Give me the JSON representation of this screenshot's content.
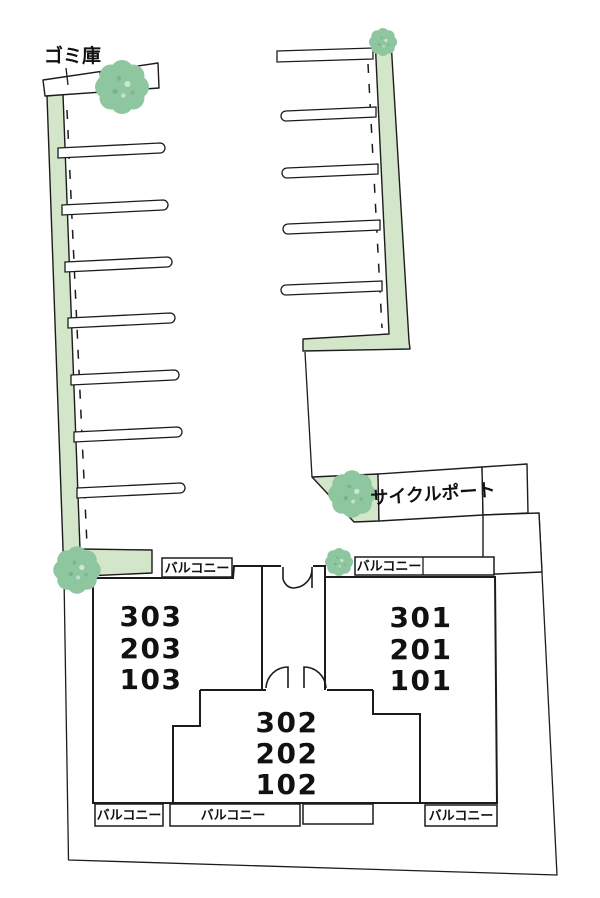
{
  "labels": {
    "garbage_storage": "ゴミ庫",
    "cycle_port": "サイクルポート",
    "balcony": "バルコニー"
  },
  "units": {
    "west": [
      "303",
      "203",
      "103"
    ],
    "center": [
      "302",
      "202",
      "102"
    ],
    "east": [
      "301",
      "201",
      "101"
    ]
  },
  "counts": {
    "parking_stalls_west": 7,
    "parking_stalls_east": 5,
    "trees": 5
  },
  "colors": {
    "planting_green": "#d4e6c9",
    "tree_green": "#8ec79f",
    "line": "#1c1c1c",
    "background": "#ffffff"
  }
}
